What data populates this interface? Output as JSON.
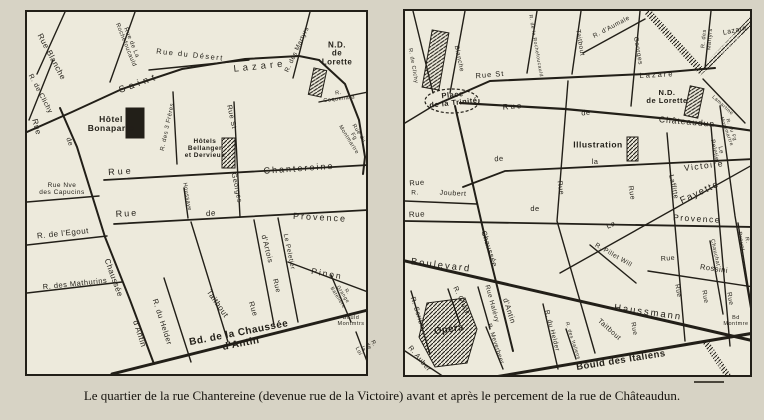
{
  "palette": {
    "paper": "#d7d3c5",
    "map_bg": "#edeadc",
    "ink": "#221f18",
    "label_light": "#efece0"
  },
  "caption": "Le quartier de la rue Chantereine (devenue rue de la Victoire) avant et après le percement de la rue de Châteaudun.",
  "maps": [
    {
      "name": "plan-avant-percement",
      "streets": [
        {
          "p": "38,0 10,62"
        },
        {
          "p": "26,48 2,108"
        },
        {
          "p": "33,96 50,135 78,225 103,288 127,352",
          "w": 2
        },
        {
          "p": "0,120 45,100 95,77 155,57 218,47 272,44 292,48",
          "w": 2
        },
        {
          "p": "292,48 318,72 332,108 338,145 336,162",
          "w": 2
        },
        {
          "p": "108,0 83,70"
        },
        {
          "p": "122,58 222,48"
        },
        {
          "p": "146,80 150,152"
        },
        {
          "p": "207,90 213,205"
        },
        {
          "p": "283,0 266,66"
        },
        {
          "p": "292,90 341,80"
        },
        {
          "p": "77,168 341,153",
          "w": 1.8
        },
        {
          "p": "87,212 341,198",
          "w": 1.8
        },
        {
          "p": "0,190 72,184"
        },
        {
          "p": "0,233 80,224"
        },
        {
          "p": "0,281 95,270"
        },
        {
          "p": "157,176 161,206"
        },
        {
          "p": "227,208 247,313"
        },
        {
          "p": "251,206 271,310"
        },
        {
          "p": "261,250 341,280"
        },
        {
          "p": "304,263 324,310"
        },
        {
          "p": "164,210 201,330"
        },
        {
          "p": "137,266 164,350"
        },
        {
          "p": "85,362 341,298",
          "w": 3
        },
        {
          "p": "329,320 344,360"
        }
      ],
      "bands": [],
      "buildings": [
        {
          "x": 99,
          "y": 96,
          "w": 18,
          "h": 30,
          "fill": "ink"
        },
        {
          "x": 195,
          "y": 126,
          "w": 13,
          "h": 30,
          "fill": "hatch"
        },
        {
          "x": 284,
          "y": 57,
          "w": 13,
          "h": 27,
          "rot": 12,
          "fill": "hatch"
        }
      ],
      "ellipses": [],
      "labels": [
        {
          "t": "Rue Blanche",
          "x": 24,
          "y": 45,
          "r": 62,
          "s": 8
        },
        {
          "t": "R. de Clichy",
          "x": 13,
          "y": 82,
          "r": 62,
          "s": 7
        },
        {
          "t": "Rue",
          "x": 9,
          "y": 115,
          "r": 75,
          "s": 8
        },
        {
          "t": "de",
          "x": 42,
          "y": 130,
          "r": 70,
          "s": 7
        },
        {
          "t": "Rue de La\nRochefoucauld",
          "x": 101,
          "y": 32,
          "r": 68,
          "s": 6
        },
        {
          "t": "Rue du Désert",
          "x": 163,
          "y": 43,
          "r": 6,
          "s": 7.5,
          "ls": 1.5
        },
        {
          "t": "Saint",
          "x": 112,
          "y": 72,
          "r": -20,
          "s": 9.5,
          "ls": 4
        },
        {
          "t": "Lazare",
          "x": 233,
          "y": 55,
          "r": -6,
          "s": 9.5,
          "ls": 4
        },
        {
          "t": "R. des Martyrs",
          "x": 271,
          "y": 38,
          "r": -65,
          "s": 6.5
        },
        {
          "t": "N.D. de\nLorette",
          "x": 310,
          "y": 42,
          "s": 8,
          "b": 1
        },
        {
          "t": "R. Coquenard",
          "x": 312,
          "y": 85,
          "r": -7,
          "s": 5.5
        },
        {
          "t": "Rue du\nFg Montmartre",
          "x": 326,
          "y": 125,
          "r": 58,
          "s": 5.5
        },
        {
          "t": "Hôtel\nBonaparte",
          "x": 84,
          "y": 112,
          "s": 8.5,
          "b": 1
        },
        {
          "t": "R. des 3 Frères",
          "x": 141,
          "y": 115,
          "r": -78,
          "s": 6
        },
        {
          "t": "Rue St",
          "x": 204,
          "y": 105,
          "r": 78,
          "s": 7
        },
        {
          "t": "Georges",
          "x": 209,
          "y": 176,
          "r": 78,
          "s": 7
        },
        {
          "t": "Hôtels\nBellanger\net Dervieux",
          "x": 178,
          "y": 137,
          "s": 6.5,
          "b": 1
        },
        {
          "t": "Rue",
          "x": 94,
          "y": 160,
          "r": -4,
          "s": 9,
          "ls": 3
        },
        {
          "t": "Chantereine",
          "x": 272,
          "y": 157,
          "r": -4,
          "s": 9,
          "ls": 2
        },
        {
          "t": "Rue Nve\ndes Capucins",
          "x": 35,
          "y": 178,
          "s": 6.5
        },
        {
          "t": "Rue",
          "x": 100,
          "y": 202,
          "r": -4,
          "s": 9,
          "ls": 2
        },
        {
          "t": "de",
          "x": 184,
          "y": 202,
          "r": -4,
          "s": 8
        },
        {
          "t": "Provence",
          "x": 293,
          "y": 206,
          "r": 3,
          "s": 9,
          "ls": 2
        },
        {
          "t": "Houssaye",
          "x": 159,
          "y": 185,
          "r": 80,
          "s": 5.5
        },
        {
          "t": "R. de l'Egout",
          "x": 36,
          "y": 222,
          "r": -6,
          "s": 8
        },
        {
          "t": "Chaussée",
          "x": 86,
          "y": 266,
          "r": 70,
          "s": 8
        },
        {
          "t": "d'Antin",
          "x": 112,
          "y": 322,
          "r": 72,
          "s": 8
        },
        {
          "t": "R. des Mathurins",
          "x": 48,
          "y": 272,
          "r": -6,
          "s": 7.5
        },
        {
          "t": "R. du Helder",
          "x": 135,
          "y": 310,
          "r": 72,
          "s": 7.5
        },
        {
          "t": "Taitbout",
          "x": 190,
          "y": 292,
          "r": 55,
          "s": 8
        },
        {
          "t": "d'Artois",
          "x": 240,
          "y": 237,
          "r": 76,
          "s": 7.5
        },
        {
          "t": "Rue",
          "x": 226,
          "y": 297,
          "r": 73,
          "s": 7.5
        },
        {
          "t": "Le Peletier",
          "x": 261,
          "y": 240,
          "r": 78,
          "s": 6.5
        },
        {
          "t": "Rue",
          "x": 249,
          "y": 274,
          "r": 76,
          "s": 7
        },
        {
          "t": "Pinon",
          "x": 300,
          "y": 262,
          "r": 10,
          "s": 8.5,
          "ls": 2
        },
        {
          "t": "R. Grange Batelière",
          "x": 315,
          "y": 283,
          "r": 58,
          "s": 5
        },
        {
          "t": "Bd. de la Chaussée d'Antin",
          "x": 213,
          "y": 327,
          "r": -11,
          "s": 10,
          "b": 1
        },
        {
          "t": "Bould\nMontmtrs",
          "x": 324,
          "y": 310,
          "s": 5.5
        },
        {
          "t": "R. de la Loi",
          "x": 338,
          "y": 336,
          "r": 63,
          "s": 5.5
        }
      ]
    },
    {
      "name": "plan-apres-percement",
      "streets": [
        {
          "p": "28,95 85,70 240,63 310,57",
          "w": 2
        },
        {
          "p": "28,95 0,112"
        },
        {
          "p": "55,92 160,98 265,108 349,120",
          "w": 2.2
        },
        {
          "p": "58,176 100,160 349,148",
          "w": 1.8
        },
        {
          "p": "0,190 72,193"
        },
        {
          "p": "0,210 349,216",
          "w": 1.8
        },
        {
          "p": "349,153 155,262"
        },
        {
          "p": "0,250 349,330",
          "w": 3
        },
        {
          "p": "78,368 349,322",
          "w": 3
        },
        {
          "p": "50,95 78,218 108,340",
          "w": 2
        },
        {
          "p": "60,0 45,82"
        },
        {
          "p": "8,0 28,82"
        },
        {
          "p": "132,0 122,62"
        },
        {
          "p": "176,0 167,63"
        },
        {
          "p": "163,70 152,210 190,342"
        },
        {
          "p": "178,42 240,8"
        },
        {
          "p": "235,0 226,95"
        },
        {
          "p": "306,0 300,57"
        },
        {
          "p": "298,68 340,112"
        },
        {
          "p": "315,95 330,205 347,305"
        },
        {
          "p": "262,122 280,330"
        },
        {
          "p": "306,115 325,335"
        },
        {
          "p": "243,260 349,276"
        },
        {
          "p": "185,234 231,272"
        },
        {
          "p": "305,230 318,303"
        },
        {
          "p": "333,212 348,307"
        },
        {
          "p": "6,280 25,343"
        },
        {
          "p": "43,278 55,313"
        },
        {
          "p": "73,276 85,318"
        },
        {
          "p": "81,316 98,358"
        },
        {
          "p": "138,293 153,358"
        },
        {
          "p": "161,318 171,348"
        },
        {
          "p": "0,340 42,368"
        }
      ],
      "bands": [
        {
          "p": "242,0 298,62",
          "w": 7
        },
        {
          "p": "300,58 352,4",
          "w": 7
        },
        {
          "p": "300,330 325,368",
          "w": 6
        }
      ],
      "buildings": [
        {
          "x": 22,
          "y": 20,
          "w": 17,
          "h": 58,
          "rot": 10,
          "fill": "hatch"
        },
        {
          "x": 282,
          "y": 76,
          "w": 14,
          "h": 30,
          "rot": 12,
          "fill": "hatch"
        },
        {
          "x": 222,
          "y": 126,
          "w": 11,
          "h": 24,
          "fill": "hatch"
        },
        {
          "poly": "22,292 60,287 72,318 62,352 30,356 14,326",
          "fill": "hatch"
        }
      ],
      "ellipses": [
        {
          "cx": 47,
          "cy": 90,
          "rx": 27,
          "ry": 12
        }
      ],
      "labels": [
        {
          "t": "R. de Clichy",
          "x": 7,
          "y": 55,
          "r": 80,
          "s": 5.5
        },
        {
          "t": "Blanche",
          "x": 53,
          "y": 48,
          "r": 78,
          "s": 6.5
        },
        {
          "t": "Place\nde la Trinité",
          "x": 48,
          "y": 88,
          "r": -6,
          "s": 7.5,
          "b": 1
        },
        {
          "t": "R. de la Rochefoucauld",
          "x": 130,
          "y": 35,
          "r": 80,
          "s": 5
        },
        {
          "t": "Taitbout",
          "x": 174,
          "y": 32,
          "r": 80,
          "s": 6.5
        },
        {
          "t": "R. d'Aumale",
          "x": 207,
          "y": 17,
          "r": -28,
          "s": 6.5
        },
        {
          "t": "Georges",
          "x": 232,
          "y": 40,
          "r": 80,
          "s": 6.5
        },
        {
          "t": "R. des Martyrs",
          "x": 303,
          "y": 28,
          "r": -85,
          "s": 5.5
        },
        {
          "t": "R. de Maubeuge",
          "x": 326,
          "y": 32,
          "r": -47,
          "s": 5,
          "w": 1
        },
        {
          "t": "Lazare",
          "x": 330,
          "y": 20,
          "r": -12,
          "s": 7
        },
        {
          "t": "Rue St",
          "x": 85,
          "y": 64,
          "r": -5,
          "s": 7.5,
          "ls": 1
        },
        {
          "t": "Lazare",
          "x": 252,
          "y": 64,
          "r": -3,
          "s": 7.5,
          "ls": 2
        },
        {
          "t": "Rue",
          "x": 108,
          "y": 96,
          "r": -5,
          "s": 8,
          "ls": 2
        },
        {
          "t": "de",
          "x": 181,
          "y": 102,
          "r": -5,
          "s": 7.5
        },
        {
          "t": "Châteaudun",
          "x": 282,
          "y": 111,
          "r": 5,
          "s": 8.5,
          "ls": 1
        },
        {
          "t": "N.D.\nde Lorette",
          "x": 262,
          "y": 86,
          "s": 7.5,
          "b": 1
        },
        {
          "t": "Lamartine",
          "x": 317,
          "y": 95,
          "r": 42,
          "s": 5
        },
        {
          "t": "R. du Fg Montmartre",
          "x": 323,
          "y": 120,
          "r": 70,
          "s": 5
        },
        {
          "t": "Le Peletier",
          "x": 312,
          "y": 140,
          "r": 78,
          "s": 6
        },
        {
          "t": "de",
          "x": 94,
          "y": 148,
          "r": -4,
          "s": 7.5
        },
        {
          "t": "la",
          "x": 190,
          "y": 151,
          "s": 7.5
        },
        {
          "t": "Victoire",
          "x": 299,
          "y": 155,
          "r": -7,
          "s": 8.5,
          "ls": 1.5
        },
        {
          "t": "Illustration",
          "x": 193,
          "y": 134,
          "s": 8.5,
          "b": 1
        },
        {
          "t": "Rue",
          "x": 155,
          "y": 177,
          "r": 80,
          "s": 7
        },
        {
          "t": "Rue",
          "x": 226,
          "y": 182,
          "r": 80,
          "s": 7
        },
        {
          "t": "Laffitte",
          "x": 268,
          "y": 176,
          "r": 78,
          "s": 7
        },
        {
          "t": "Rue",
          "x": 12,
          "y": 172,
          "r": -4,
          "s": 7.5
        },
        {
          "t": "R.",
          "x": 10,
          "y": 183,
          "s": 6.5
        },
        {
          "t": "Joubert",
          "x": 48,
          "y": 183,
          "r": 3,
          "s": 7
        },
        {
          "t": "Rue",
          "x": 12,
          "y": 204,
          "r": -3,
          "s": 8
        },
        {
          "t": "de",
          "x": 130,
          "y": 198,
          "s": 7.5
        },
        {
          "t": "Provence",
          "x": 292,
          "y": 208,
          "r": 3,
          "s": 8.5,
          "ls": 1.5
        },
        {
          "t": "La",
          "x": 206,
          "y": 214,
          "r": -25,
          "s": 7.5
        },
        {
          "t": "Fayette",
          "x": 295,
          "y": 182,
          "r": -25,
          "s": 9.5,
          "ls": 1.5
        },
        {
          "t": "Chaussée",
          "x": 84,
          "y": 238,
          "r": 72,
          "s": 7.5
        },
        {
          "t": "d'Antin",
          "x": 104,
          "y": 300,
          "r": 72,
          "s": 7.5
        },
        {
          "t": "Boulevard",
          "x": 36,
          "y": 255,
          "r": 7,
          "s": 9.5,
          "ls": 2
        },
        {
          "t": "Haussmann",
          "x": 243,
          "y": 302,
          "r": 8,
          "s": 9.5,
          "ls": 2
        },
        {
          "t": "R. Scribe",
          "x": 12,
          "y": 302,
          "r": 72,
          "s": 7
        },
        {
          "t": "R. Gluck",
          "x": 56,
          "y": 290,
          "r": 65,
          "s": 7
        },
        {
          "t": "Rue Halévy",
          "x": 86,
          "y": 293,
          "r": 75,
          "s": 6.5
        },
        {
          "t": "R. Meyerbeer",
          "x": 90,
          "y": 333,
          "r": 72,
          "s": 6
        },
        {
          "t": "R. Auber",
          "x": 14,
          "y": 348,
          "r": 50,
          "s": 7
        },
        {
          "t": "Opéra",
          "x": 44,
          "y": 319,
          "r": -8,
          "s": 9.5,
          "b": 1
        },
        {
          "t": "R. du Helder",
          "x": 146,
          "y": 320,
          "r": 75,
          "s": 6.5
        },
        {
          "t": "R. des Italiens",
          "x": 167,
          "y": 330,
          "r": 72,
          "s": 5
        },
        {
          "t": "R. Pillet Will",
          "x": 208,
          "y": 245,
          "r": 30,
          "s": 6.5
        },
        {
          "t": "Rue",
          "x": 228,
          "y": 318,
          "r": 80,
          "s": 6.5
        },
        {
          "t": "Taitbout",
          "x": 204,
          "y": 319,
          "r": 42,
          "s": 7
        },
        {
          "t": "Rue",
          "x": 263,
          "y": 248,
          "r": -5,
          "s": 7
        },
        {
          "t": "Rossini",
          "x": 309,
          "y": 258,
          "r": 8,
          "s": 7.5
        },
        {
          "t": "Rue",
          "x": 272,
          "y": 280,
          "r": 80,
          "s": 6.5
        },
        {
          "t": "Rue",
          "x": 299,
          "y": 286,
          "r": 80,
          "s": 6.5
        },
        {
          "t": "Rue",
          "x": 324,
          "y": 288,
          "r": 80,
          "s": 6.5
        },
        {
          "t": "Chauchat",
          "x": 309,
          "y": 242,
          "r": 78,
          "s": 5.5
        },
        {
          "t": "R. Drouot",
          "x": 338,
          "y": 230,
          "r": 80,
          "s": 5.5
        },
        {
          "t": "Bould des Italiens",
          "x": 216,
          "y": 350,
          "r": -9,
          "s": 9.5,
          "b": 1
        },
        {
          "t": "Bd\nMontmre",
          "x": 331,
          "y": 311,
          "s": 5.5
        },
        {
          "t": "R. Richelieu",
          "x": 313,
          "y": 349,
          "r": 62,
          "s": 5,
          "w": 1
        }
      ]
    }
  ]
}
